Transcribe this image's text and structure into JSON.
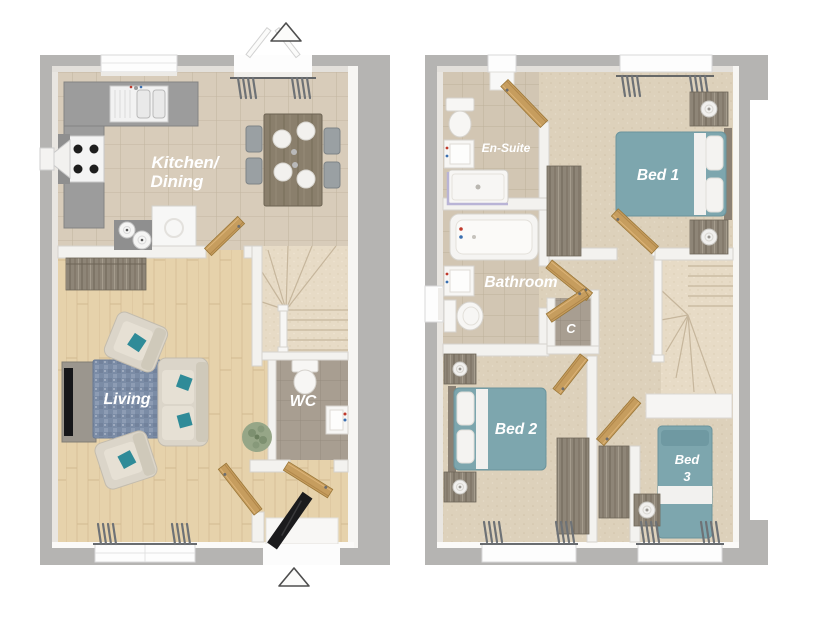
{
  "ground_floor": {
    "kitchen_line1": "Kitchen/",
    "kitchen_line2": "Dining",
    "living": "Living",
    "wc": "WC"
  },
  "first_floor": {
    "ensuite": "En-Suite",
    "bed1": "Bed 1",
    "bathroom": "Bathroom",
    "cupboard": "C",
    "bed2": "Bed 2",
    "bed3_line1": "Bed",
    "bed3_line2": "3"
  },
  "icons": {
    "entrance_arrow_top": "triangle-up",
    "entrance_arrow_bottom": "triangle-up"
  },
  "colors": {
    "wall_gray": "#b5b4b2",
    "inner_wall": "#f3f2ef",
    "bed_teal": "#7da6ae",
    "accent_teal": "#2f8b98",
    "rug_blue": "#7b8ca6",
    "door_wood": "#c69d5e",
    "front_door_black": "#1b1b1d",
    "kitchen_tile": "#d8ccba",
    "bath_tile": "#d2c6b3",
    "wc_tile": "#a89e91",
    "wood_floor": "#e6d2ab",
    "carpet": "#ddd1bb",
    "stair_carpet": "#e7dbc6",
    "counter_gray": "#9c9c9c",
    "furniture_wood": "#8e8577",
    "curtain_gray": "#6e7276",
    "label_white": "#ffffff"
  }
}
